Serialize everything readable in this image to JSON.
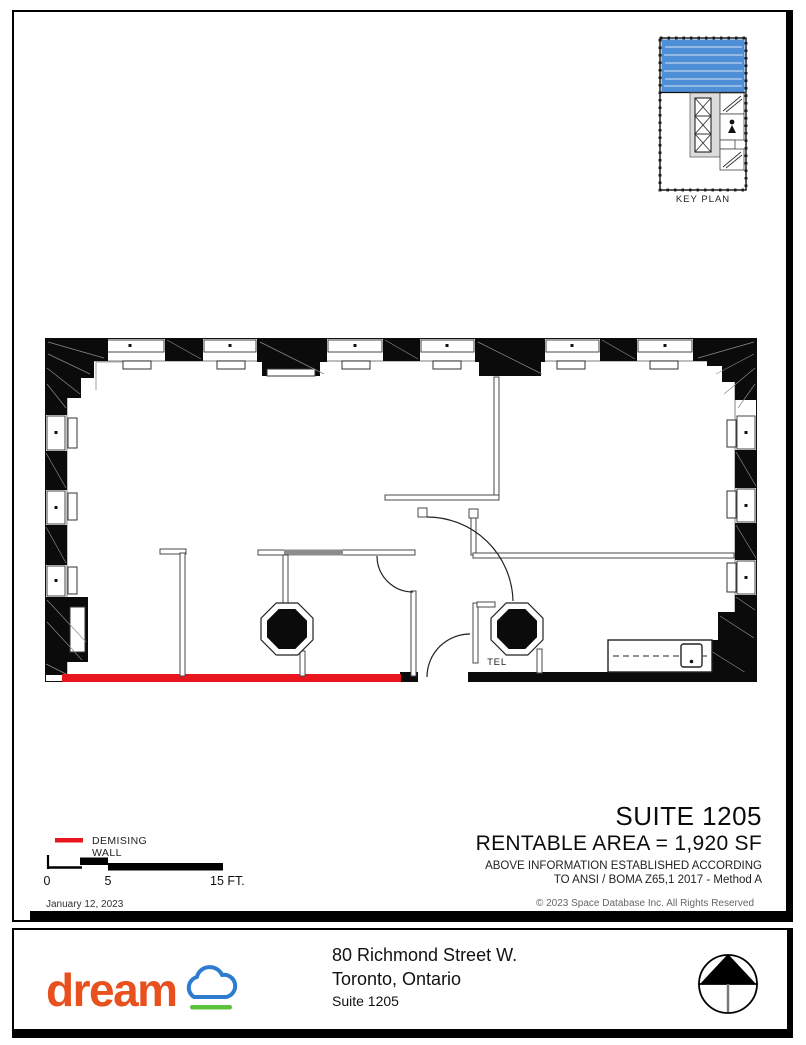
{
  "sheet": {
    "key_plan": {
      "label": "KEY PLAN"
    },
    "floor_plan": {
      "tel_label": "TEL"
    },
    "title_block": {
      "suite": "SUITE 1205",
      "rentable_area": "RENTABLE AREA = 1,920 SF",
      "boma_line1": "ABOVE INFORMATION ESTABLISHED ACCORDING",
      "boma_line2": "TO ANSI / BOMA Z65,1 2017 - Method A"
    },
    "legend": {
      "demising_label": "DEMISING WALL"
    },
    "scale_bar": {
      "tick_0": "0",
      "tick_5": "5",
      "tick_15": "15 FT."
    },
    "margin": {
      "date": "January 12, 2023",
      "copyright": "© 2023 Space Database Inc. All Rights Reserved"
    }
  },
  "footer": {
    "logo_text": "dream",
    "address_line1": "80 Richmond Street W.",
    "address_line2": "Toronto, Ontario",
    "address_line3": "Suite 1205"
  },
  "colors": {
    "suite_blue": "#4E8FD8",
    "demising_red": "#E8161C",
    "logo_orange": "#E8501E",
    "cloud_blue": "#2E7CD0",
    "underline_green": "#5BC23B"
  }
}
